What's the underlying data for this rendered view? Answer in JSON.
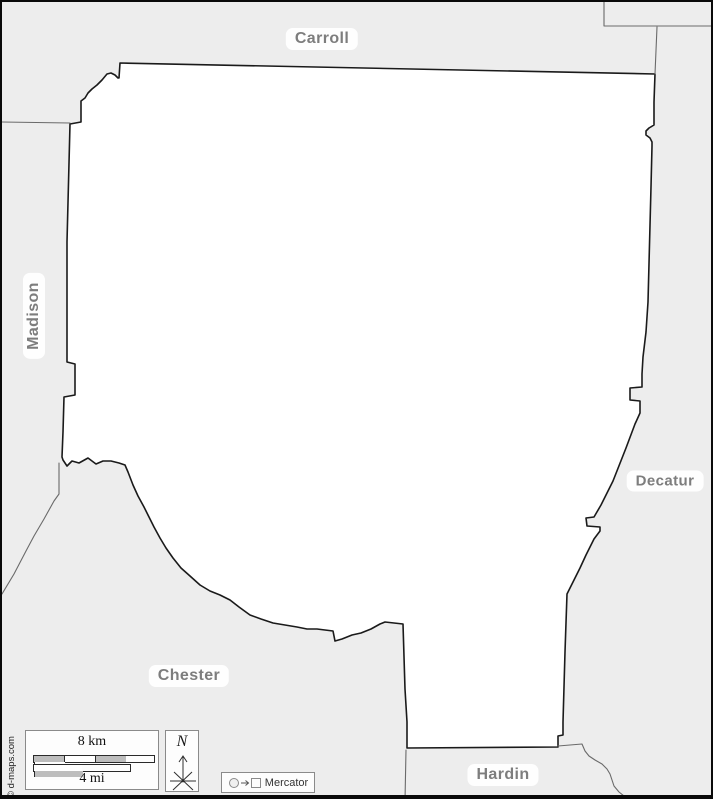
{
  "map": {
    "projection_label": "Mercator",
    "credit": "© d-maps.com",
    "region_labels": [
      {
        "id": "carroll",
        "text": "Carroll"
      },
      {
        "id": "madison",
        "text": "Madison"
      },
      {
        "id": "decatur",
        "text": "Decatur"
      },
      {
        "id": "chester",
        "text": "Chester"
      },
      {
        "id": "hardin",
        "text": "Hardin"
      }
    ],
    "colors": {
      "outside_fill": "#ededed",
      "county_fill": "#ffffff",
      "county_border": "#1a1a1a",
      "neighbor_border": "#6a6a6a",
      "label_text": "#7d7d7d",
      "frame": "#000000",
      "scale_segment_gray": "#bdbdbd"
    }
  },
  "scale_bar": {
    "km_label": "8 km",
    "mi_label": "4 mi"
  },
  "north_indicator": {
    "letter": "N"
  }
}
